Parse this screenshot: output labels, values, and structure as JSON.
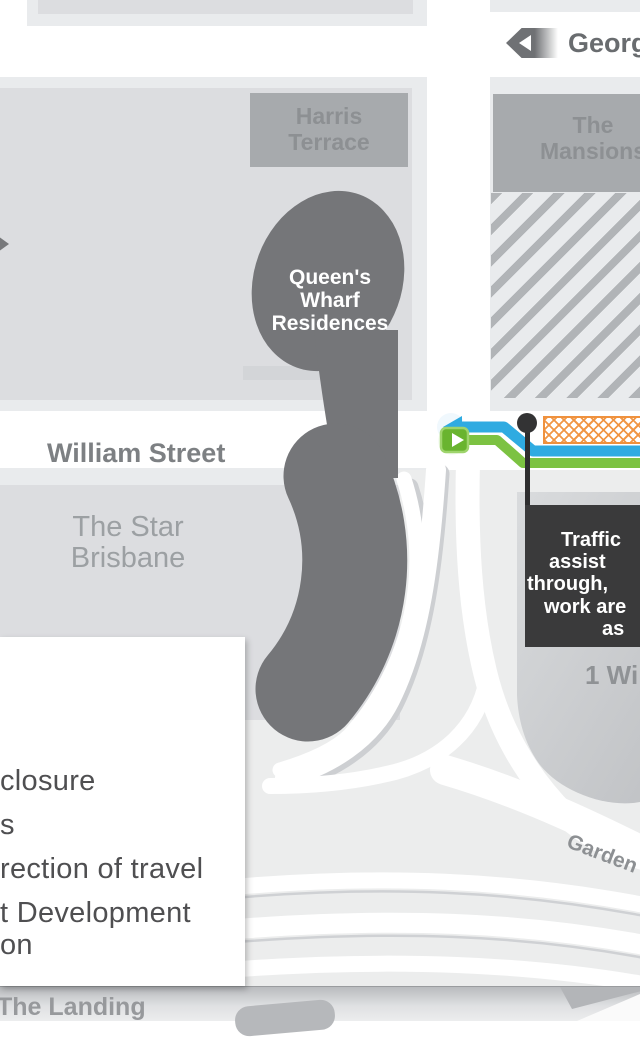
{
  "labels": {
    "george_street": "Georg",
    "william_street": "William Street",
    "gardens_point": "Garden",
    "one_william": "1 Wi",
    "the_landing": "The Landing",
    "harris_terrace": [
      "Harris",
      "Terrace"
    ],
    "the_mansions": [
      "The",
      "Mansions"
    ],
    "queens_wharf_residences": [
      "Queen's",
      "Wharf",
      "Residences"
    ],
    "star_brisbane": [
      "The Star",
      "Brisbane"
    ]
  },
  "callout": {
    "lines": [
      "Traffic",
      "assist",
      "through,",
      "work are",
      "as"
    ]
  },
  "legend": {
    "items": [
      "closure",
      "s",
      "rection of travel",
      "t Development",
      "on"
    ]
  },
  "colors": {
    "route_blue": "#2fabe1",
    "route_green": "#7cc242",
    "work_zone_orange": "#ef913d",
    "closure_dark_gray": "#757679",
    "callout_bg": "#3a3a3b",
    "building_gray": "#a7aaad",
    "block_light_gray": "#dcdde0"
  }
}
